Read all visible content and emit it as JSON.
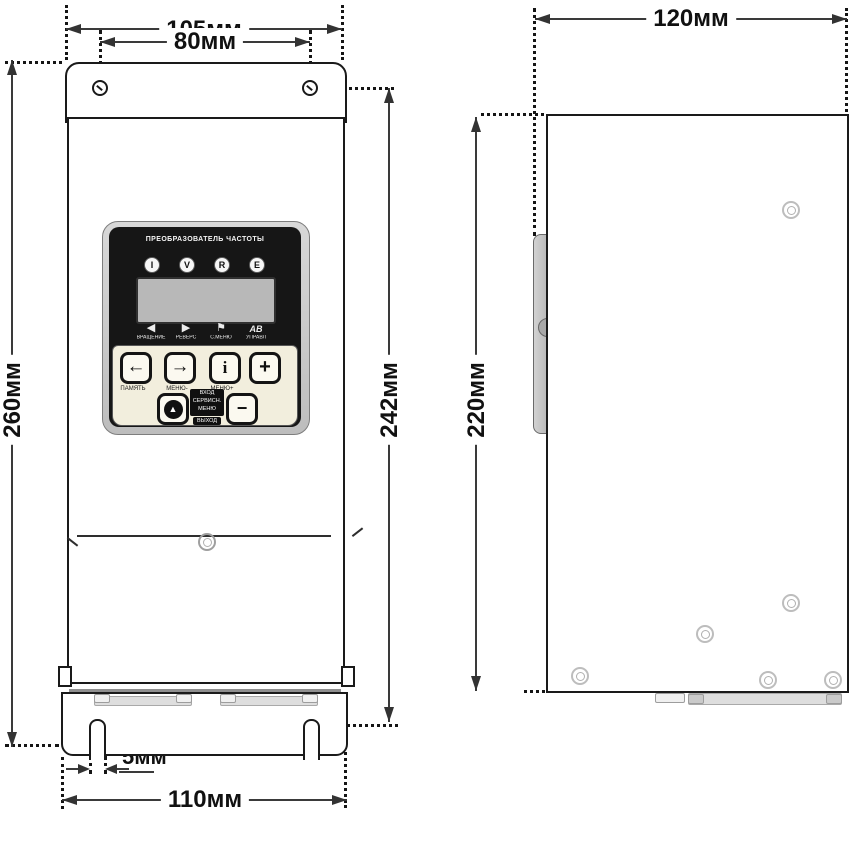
{
  "drawing": {
    "front_dims": {
      "overall_width": "105мм",
      "hole_spacing": "80мм",
      "overall_height": "260мм",
      "mounting_height": "242мм",
      "slot_width": "5мм",
      "base_width": "110мм"
    },
    "side_dims": {
      "depth": "120мм",
      "body_height": "220мм"
    }
  },
  "panel": {
    "title": "ПРЕОБРАЗОВАТЕЛЬ ЧАСТОТЫ",
    "leds": [
      "I",
      "V",
      "R",
      "E"
    ],
    "status_icons": [
      {
        "glyph": "◀",
        "label": "ВРАЩЕНИЕ"
      },
      {
        "glyph": "▶",
        "label": "РЕВЕРС"
      },
      {
        "glyph": "⚑",
        "label": "С.МЕНЮ"
      },
      {
        "glyph": "АВ",
        "label": "УПРАВЛ"
      }
    ],
    "keys_row1": [
      {
        "glyph": "←",
        "label": "ПАМЯТЬ"
      },
      {
        "glyph": "→",
        "label": "МЕНЮ-"
      },
      {
        "glyph": "i",
        "label": "МЕНЮ+"
      },
      {
        "glyph": "+",
        "label": ""
      }
    ],
    "info_block": {
      "lines": [
        "ВХОД",
        "СЕРВИСН.",
        "МЕНЮ"
      ],
      "exit": "ВЫХОД"
    },
    "keys_row2": [
      {
        "glyph": "▲"
      },
      {
        "glyph": "−"
      }
    ]
  },
  "colors": {
    "outline": "#1a1a1a",
    "dimension": "#3a3a3a",
    "bezel": "#161616",
    "keypad": "#f2eedd",
    "lcd": "#b8b8b8"
  }
}
